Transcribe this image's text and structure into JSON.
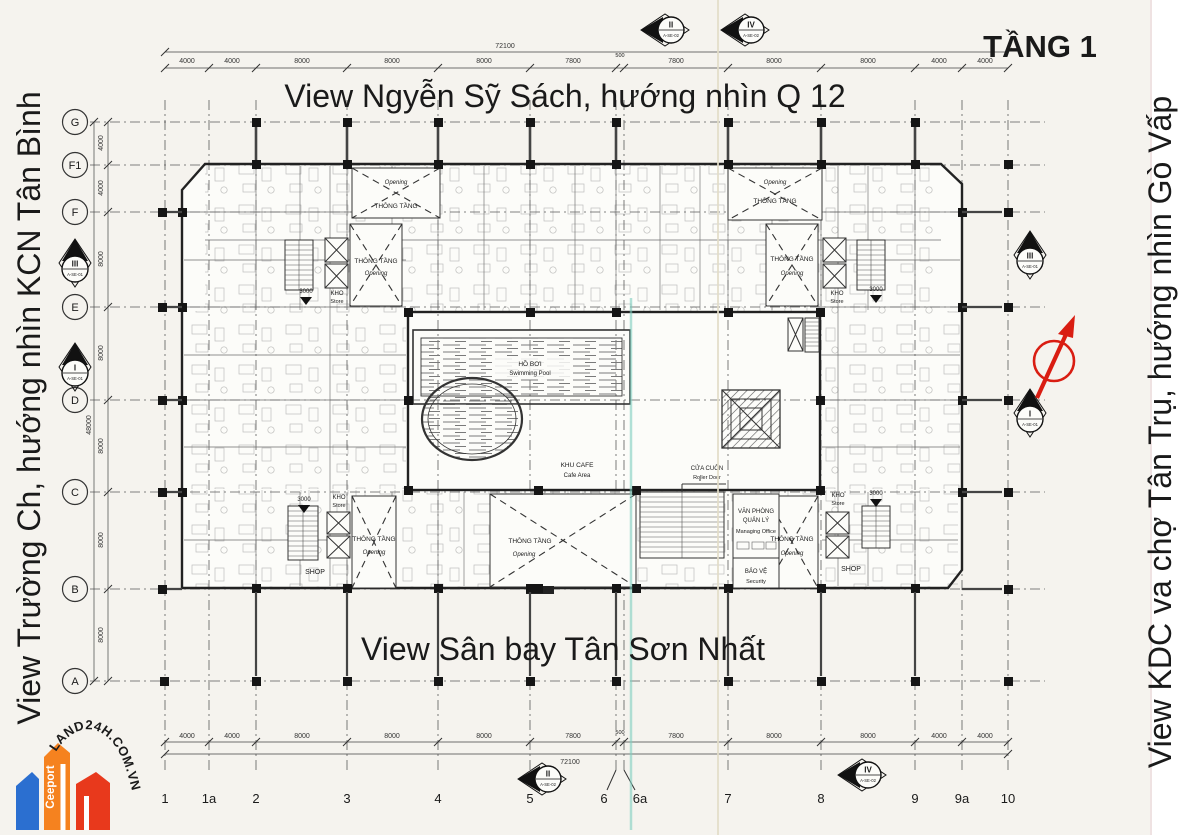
{
  "title": "TẦNG 1",
  "annotations": {
    "top": "View Ngyễn Sỹ Sách, hướng nhìn Q 12",
    "bottom": "View Sân bay Tân Sơn Nhất",
    "left": "View Trường Ch, hướng nhìn KCN Tân Bình",
    "right": "View KDC va chợ Tân Trụ, hướng nhìn Gò Vấp",
    "color": "#1c2ed1",
    "title_color": "#e41511"
  },
  "grid": {
    "cols": [
      "1",
      "1a",
      "2",
      "3",
      "4",
      "5",
      "6",
      "6a",
      "7",
      "8",
      "9",
      "9a",
      "10"
    ],
    "rows": [
      "G",
      "F1",
      "F",
      "E",
      "D",
      "C",
      "B",
      "A"
    ]
  },
  "dims": {
    "total_w": "72100",
    "total_h": "48000",
    "h": [
      "4000",
      "4000",
      "8000",
      "8000",
      "8000",
      "7800",
      "500",
      "7800",
      "8000",
      "8000",
      "4000",
      "4000"
    ],
    "v": [
      "4000",
      "4000",
      "8000",
      "8000",
      "8000",
      "8000",
      "8000"
    ]
  },
  "markers": {
    "ii": {
      "num": "II",
      "code": "A-SE-02"
    },
    "iv": {
      "num": "IV",
      "code": "A-SE-02"
    },
    "iii": {
      "num": "III",
      "code": "A-SE-01"
    },
    "i": {
      "num": "I",
      "code": "A-SE-01"
    }
  },
  "compass": {
    "color": "#d91d12"
  },
  "rooms": {
    "pool_vi": "HỒ BƠI",
    "pool_en": "Swimming Pool",
    "cafe_vi": "KHU CAFE",
    "cafe_en": "Cafe Area",
    "roller_vi": "CỬA CUỐN",
    "roller_en": "Roller Door",
    "office_vi1": "VĂN PHÒNG",
    "office_vi2": "QUẢN LÝ",
    "office_en": "Managing Office",
    "security_vi": "BẢO VỆ",
    "security_en": "Security",
    "void_vi": "THÔNG TẦNG",
    "void_en": "Opening",
    "store_vi": "KHO",
    "store_en": "Store",
    "shop": "SHOP",
    "dim3000": "3000"
  },
  "logo": {
    "brand": "Ceeport",
    "site": "LAND24H.COM.VN",
    "blue": "#2b6fd0",
    "orange": "#f5821f",
    "red": "#e8391c",
    "text_color": "#3340cc"
  }
}
